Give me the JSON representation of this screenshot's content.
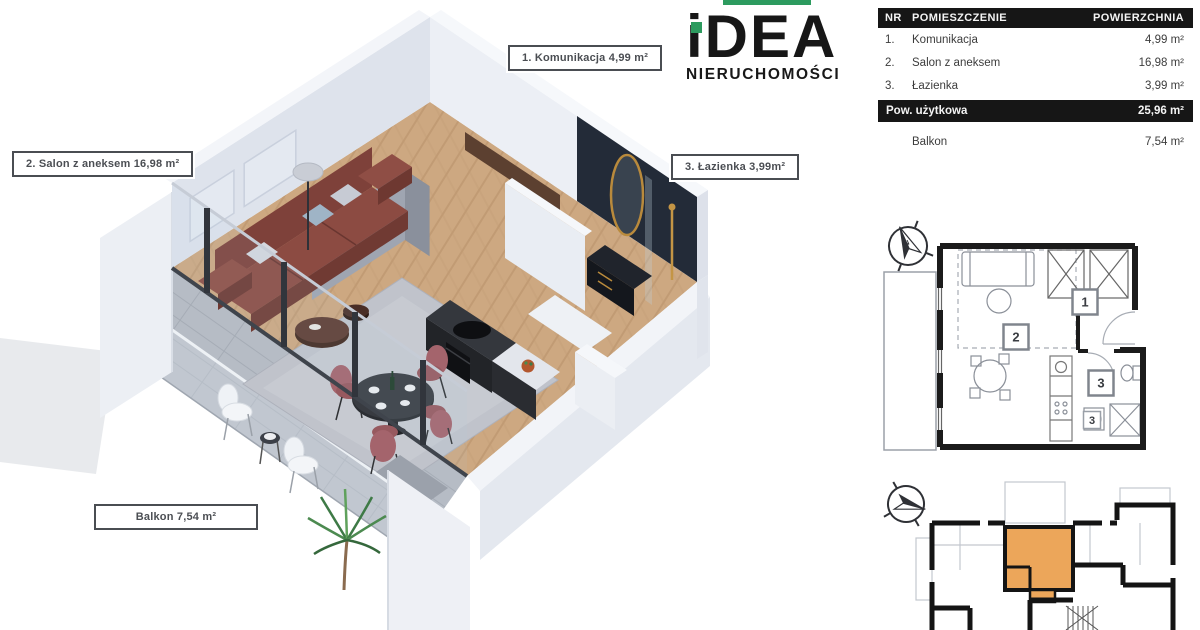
{
  "logo": {
    "brand": "iDEA",
    "subtitle": "NIERUCHOMOŚCI",
    "accent_color": "#2D9B5F"
  },
  "table": {
    "headers": {
      "nr": "NR",
      "room": "POMIESZCZENIE",
      "area": "POWIERZCHNIA"
    },
    "rows": [
      {
        "nr": "1.",
        "room": "Komunikacja",
        "area": "4,99 m²"
      },
      {
        "nr": "2.",
        "room": "Salon z aneksem",
        "area": "16,98 m²"
      },
      {
        "nr": "3.",
        "room": "Łazienka",
        "area": "3,99 m²"
      }
    ],
    "summary": {
      "label": "Pow. użytkowa",
      "area": "25,96 m²"
    },
    "extra": {
      "label": "Balkon",
      "area": "7,54 m²"
    }
  },
  "plan3d": {
    "labels": [
      {
        "id": "komunikacja",
        "text": "1. Komunikacja 4,99 m²"
      },
      {
        "id": "salon",
        "text": "2. Salon z aneksem 16,98 m²"
      },
      {
        "id": "lazienka",
        "text": "3. Łazienka 3,99m²"
      },
      {
        "id": "balkon",
        "text": "Balkon 7,54 m²"
      }
    ]
  },
  "plan2d": {
    "compass": "N",
    "box1": "1",
    "box2": "2",
    "box3": "3",
    "box3b": "3"
  },
  "building": {
    "unit_color": "#ECA65A"
  }
}
